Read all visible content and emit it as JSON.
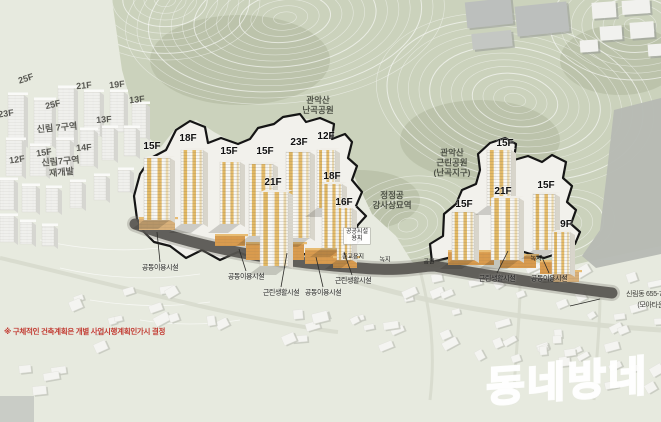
{
  "colors": {
    "ground": "#e7eadf",
    "terrain_green": "#cbd2bc",
    "terrain_shade": "#b9c2a8",
    "contour": "#ffffff",
    "site_fill": "#f2f1ec",
    "site_outline": "#151515",
    "road_dark": "#55534f",
    "road_light": "#d7dacd",
    "grey_road": "#b6b9b3",
    "tower_front": "#f8f7f3",
    "tower_side": "#d8d5cb",
    "tower_accent": "#e2b55c",
    "podium": "#d99b4e",
    "podium_light": "#d8b07a",
    "house": "#f4f4f1",
    "house_shadow": "#c3c6bc",
    "note_red": "#c23b32"
  },
  "scene": {
    "red_note": "※ 구체적인 건축계획은 개별 사업시행계획인가시 결정",
    "watermark": "동네방네",
    "address_line1": "신림동 655-78",
    "address_line2": "(모아타운)"
  },
  "labels": {
    "site_floors": [
      {
        "t": "15F",
        "x": 152,
        "y": 147
      },
      {
        "t": "18F",
        "x": 188,
        "y": 139
      },
      {
        "t": "15F",
        "x": 229,
        "y": 152
      },
      {
        "t": "15F",
        "x": 265,
        "y": 152
      },
      {
        "t": "23F",
        "x": 299,
        "y": 143
      },
      {
        "t": "12F",
        "x": 326,
        "y": 137
      },
      {
        "t": "21F",
        "x": 273,
        "y": 183
      },
      {
        "t": "18F",
        "x": 332,
        "y": 177
      },
      {
        "t": "16F",
        "x": 344,
        "y": 203
      },
      {
        "t": "15F",
        "x": 505,
        "y": 144
      },
      {
        "t": "21F",
        "x": 503,
        "y": 192
      },
      {
        "t": "15F",
        "x": 546,
        "y": 186
      },
      {
        "t": "15F",
        "x": 464,
        "y": 205
      },
      {
        "t": "9F",
        "x": 566,
        "y": 225
      }
    ],
    "bg_floors": [
      {
        "t": "25F",
        "x": 26,
        "y": 79,
        "r": -18
      },
      {
        "t": "21F",
        "x": 84,
        "y": 86,
        "r": -6
      },
      {
        "t": "19F",
        "x": 117,
        "y": 85,
        "r": -6
      },
      {
        "t": "23F",
        "x": 6,
        "y": 114,
        "r": -8
      },
      {
        "t": "25F",
        "x": 53,
        "y": 105,
        "r": -14
      },
      {
        "t": "13F",
        "x": 137,
        "y": 100,
        "r": -6
      },
      {
        "t": "13F",
        "x": 104,
        "y": 120,
        "r": -4
      },
      {
        "t": "14F",
        "x": 84,
        "y": 148,
        "r": -4
      },
      {
        "t": "15F",
        "x": 44,
        "y": 153,
        "r": -8
      },
      {
        "t": "12F",
        "x": 17,
        "y": 160,
        "r": -8
      }
    ],
    "areas": [
      {
        "t": "신림 7구역",
        "x": 57,
        "y": 128,
        "r": -5,
        "cls": "district"
      },
      {
        "t": "신림7구역\n재개발",
        "x": 61,
        "y": 167,
        "r": -5,
        "cls": "district"
      },
      {
        "t": "관악산\n난곡공원",
        "x": 318,
        "y": 105,
        "r": 0,
        "cls": "park"
      },
      {
        "t": "관악산\n근린공원\n(난곡지구)",
        "x": 452,
        "y": 163,
        "r": 0,
        "cls": "park"
      },
      {
        "t": "정정공\n강사상묘역",
        "x": 392,
        "y": 200,
        "r": 0,
        "cls": "park"
      }
    ],
    "facilities": [
      {
        "t": "공동이용시설",
        "x": 160,
        "y": 268
      },
      {
        "t": "공동이용시설",
        "x": 246,
        "y": 277
      },
      {
        "t": "근린생활시설",
        "x": 281,
        "y": 293
      },
      {
        "t": "공동이용시설",
        "x": 323,
        "y": 293
      },
      {
        "t": "근린생활시설",
        "x": 353,
        "y": 281
      },
      {
        "t": "근린생활시설",
        "x": 497,
        "y": 279
      },
      {
        "t": "공동이용시설",
        "x": 549,
        "y": 279
      }
    ],
    "land_use": [
      {
        "t": "공공시설\n용지",
        "x": 357,
        "y": 236,
        "boxed": true
      },
      {
        "t": "종교용지",
        "x": 353,
        "y": 258,
        "boxed": false
      },
      {
        "t": "녹지",
        "x": 385,
        "y": 261,
        "boxed": false
      },
      {
        "t": "공원",
        "x": 429,
        "y": 263,
        "boxed": false
      },
      {
        "t": "녹지",
        "x": 536,
        "y": 260,
        "boxed": false
      }
    ]
  }
}
